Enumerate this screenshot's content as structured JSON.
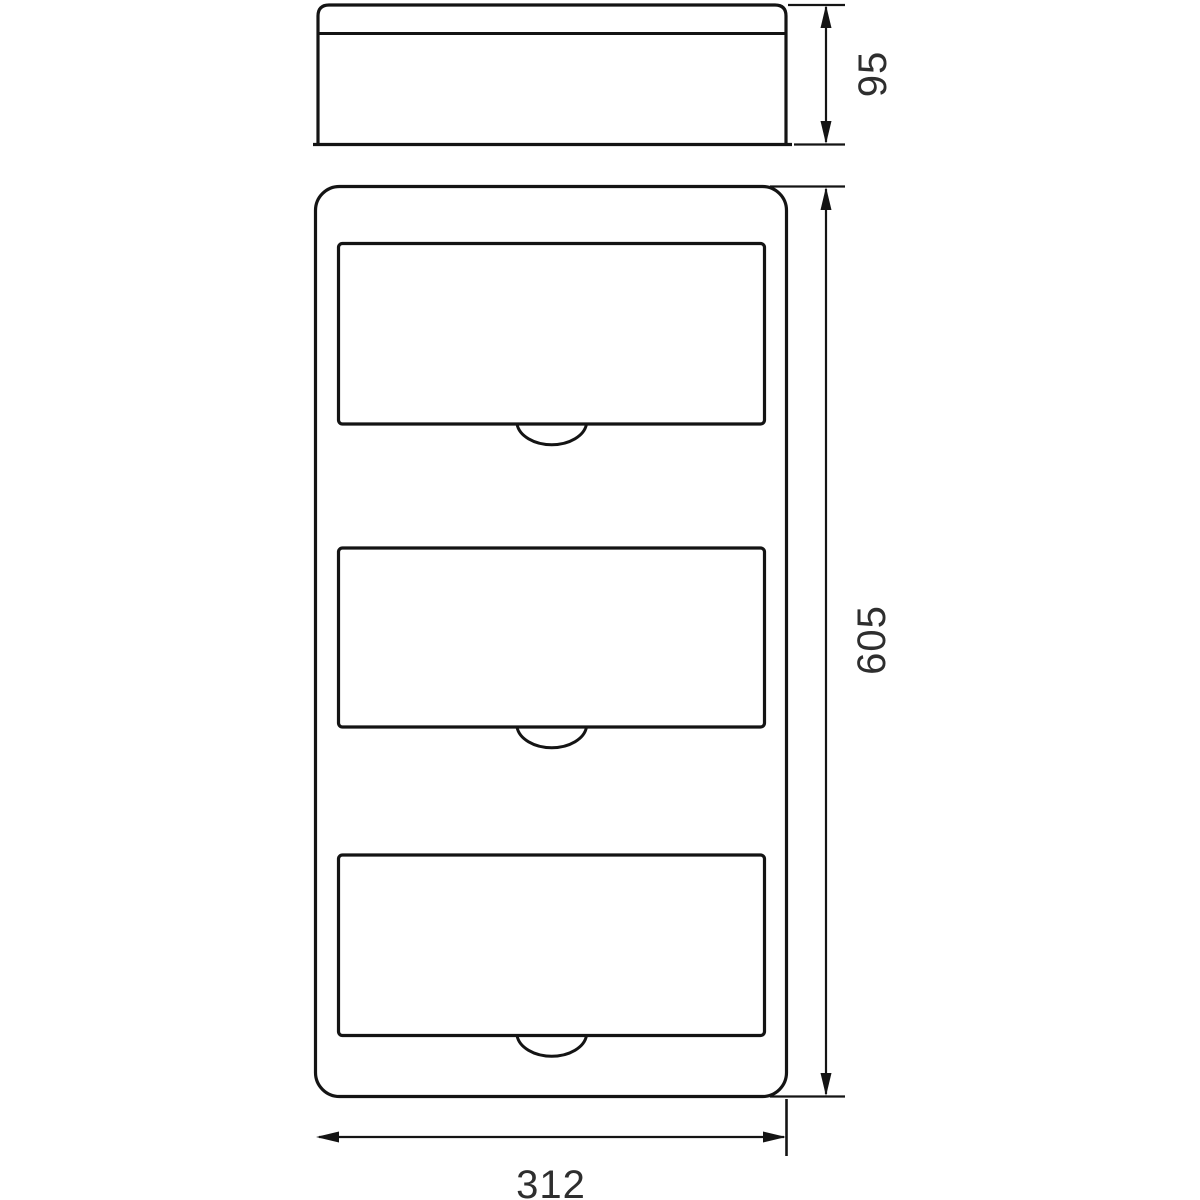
{
  "drawing": {
    "type": "technical-dimension-drawing",
    "views": {
      "side_view": {
        "description_label": "",
        "depth_dimension": "95"
      },
      "front_view": {
        "module_window_count": 3,
        "height_dimension": "605",
        "width_dimension": "312"
      }
    },
    "dimensions": {
      "depth_mm": "95",
      "height_mm": "605",
      "width_mm": "312"
    },
    "colors": {
      "line": "#141414",
      "text": "#2e2e2e",
      "background": "#ffffff"
    }
  }
}
